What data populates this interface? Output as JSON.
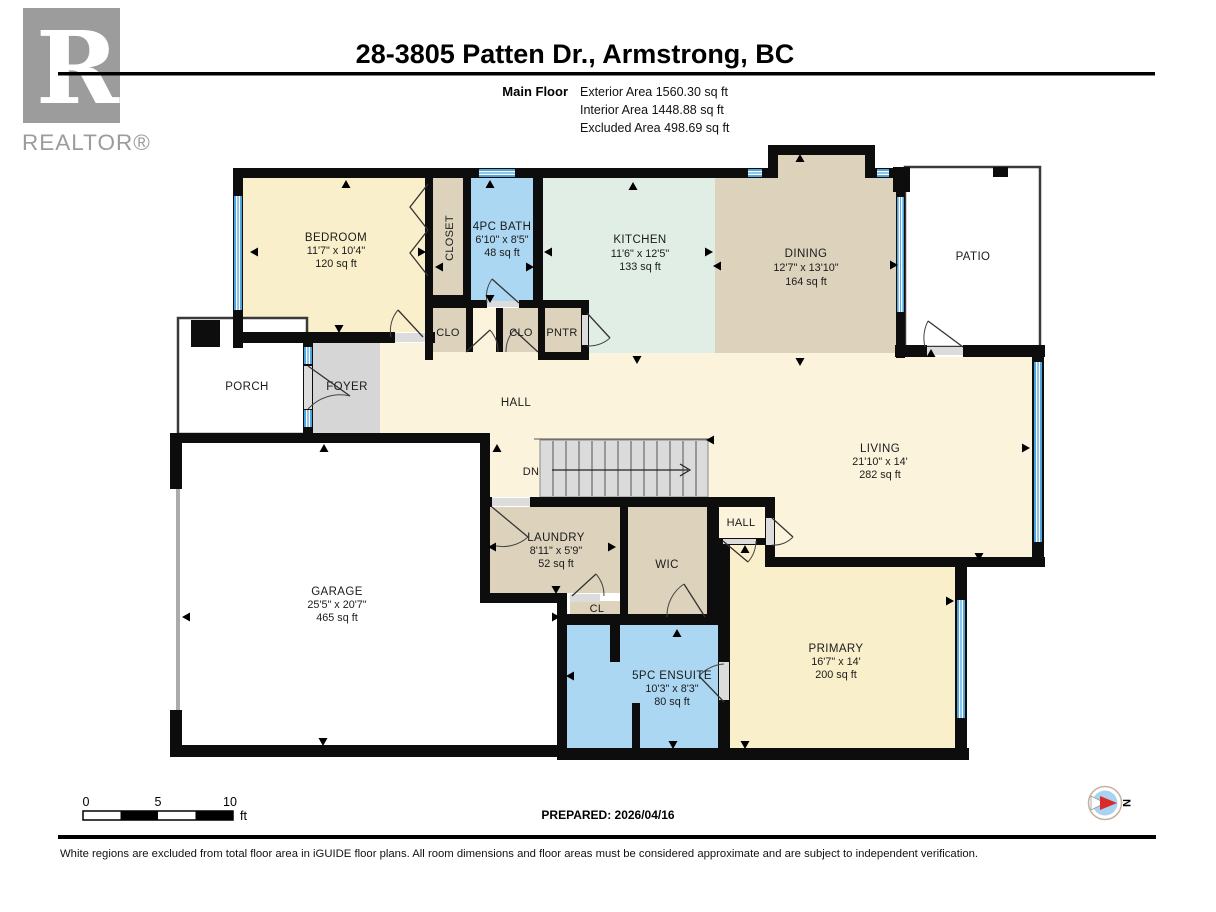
{
  "header": {
    "logo_r": "R",
    "logo_text": "REALTOR®",
    "title": "28-3805 Patten Dr., Armstrong, BC",
    "floor_label": "Main Floor",
    "stats": [
      "Exterior Area 1560.30 sq ft",
      "Interior Area 1448.88 sq ft",
      "Excluded Area 498.69 sq ft"
    ]
  },
  "rooms": {
    "bedroom": {
      "name": "BEDROOM",
      "dims": "11'7\" x 10'4\"",
      "area": "120 sq ft"
    },
    "closet": {
      "name": "CLOSET"
    },
    "bath": {
      "name": "4PC BATH",
      "dims": "6'10\" x 8'5\"",
      "area": "48 sq ft"
    },
    "kitchen": {
      "name": "KITCHEN",
      "dims": "11'6\" x 12'5\"",
      "area": "133 sq ft"
    },
    "dining": {
      "name": "DINING",
      "dims": "12'7\" x 13'10\"",
      "area": "164 sq ft"
    },
    "patio": {
      "name": "PATIO"
    },
    "porch": {
      "name": "PORCH"
    },
    "foyer": {
      "name": "FOYER"
    },
    "hall": {
      "name": "HALL"
    },
    "stairs": {
      "label": "DN"
    },
    "living": {
      "name": "LIVING",
      "dims": "21'10\" x 14'",
      "area": "282 sq ft"
    },
    "garage": {
      "name": "GARAGE",
      "dims": "25'5\" x 20'7\"",
      "area": "465 sq ft"
    },
    "laundry": {
      "name": "LAUNDRY",
      "dims": "8'11\" x 5'9\"",
      "area": "52 sq ft"
    },
    "wic": {
      "name": "WIC"
    },
    "hall2": {
      "name": "HALL"
    },
    "cl": {
      "name": "CL"
    },
    "clo1": {
      "name": "CLO"
    },
    "clo2": {
      "name": "CLO"
    },
    "pntr": {
      "name": "PNTR"
    },
    "ensuite": {
      "name": "5PC ENSUITE",
      "dims": "10'3\" x 8'3\"",
      "area": "80 sq ft"
    },
    "primary": {
      "name": "PRIMARY",
      "dims": "16'7\" x 14'",
      "area": "200 sq ft"
    }
  },
  "footer": {
    "scale": {
      "tick0": "0",
      "tick5": "5",
      "tick10": "10",
      "unit": "ft"
    },
    "prepared": "PREPARED: 2026/04/16",
    "compass_n": "N",
    "disclaimer": "White regions are excluded from total floor area in iGUIDE floor plans. All room dimensions and floor areas must be considered approximate and are subject to independent verification."
  },
  "colors": {
    "wall": "#0d0d0d",
    "room_cream": "#FAEFCB",
    "room_cream_light": "#FBF3DC",
    "room_tan": "#DDD3BD",
    "room_mint": "#E1EEE5",
    "room_blue": "#ACD7F2",
    "room_gray": "#D6D6D6",
    "window_blue": "#4BA4DC",
    "stairs_gray": "#DBDBDB",
    "logo_gray": "#9C9C9C",
    "compass_blue": "#A9D3EF",
    "compass_red": "#D92B2B"
  }
}
